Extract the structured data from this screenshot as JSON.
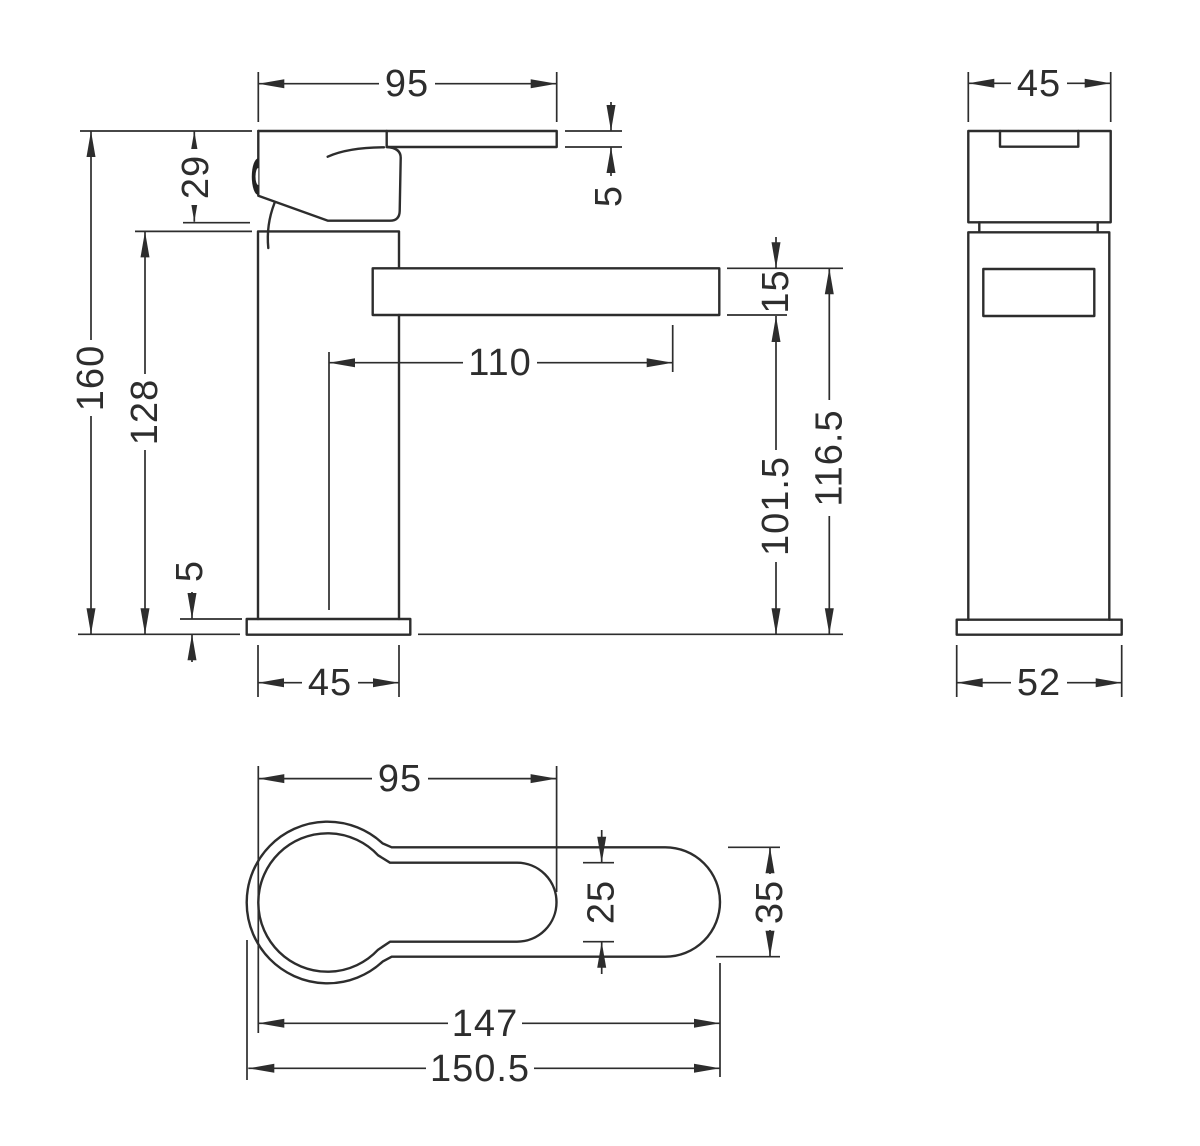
{
  "style": {
    "line_color": "#2d2d2d",
    "background": "#ffffff"
  },
  "dims": {
    "front_lever_length": "95",
    "front_lever_thickness": "5",
    "front_handle_height": "29",
    "front_total_height": "160",
    "front_body_height": "128",
    "front_base_height": "5",
    "front_body_width": "45",
    "front_spout_offset": "110",
    "front_spout_thickness": "15",
    "front_spout_underside_height": "101.5",
    "front_spout_top_height": "116.5",
    "side_body_width": "45",
    "side_base_width": "52",
    "top_handle_length": "95",
    "top_handle_width": "25",
    "top_spout_width": "35",
    "top_body_length": "147",
    "top_overall_length": "150.5"
  }
}
